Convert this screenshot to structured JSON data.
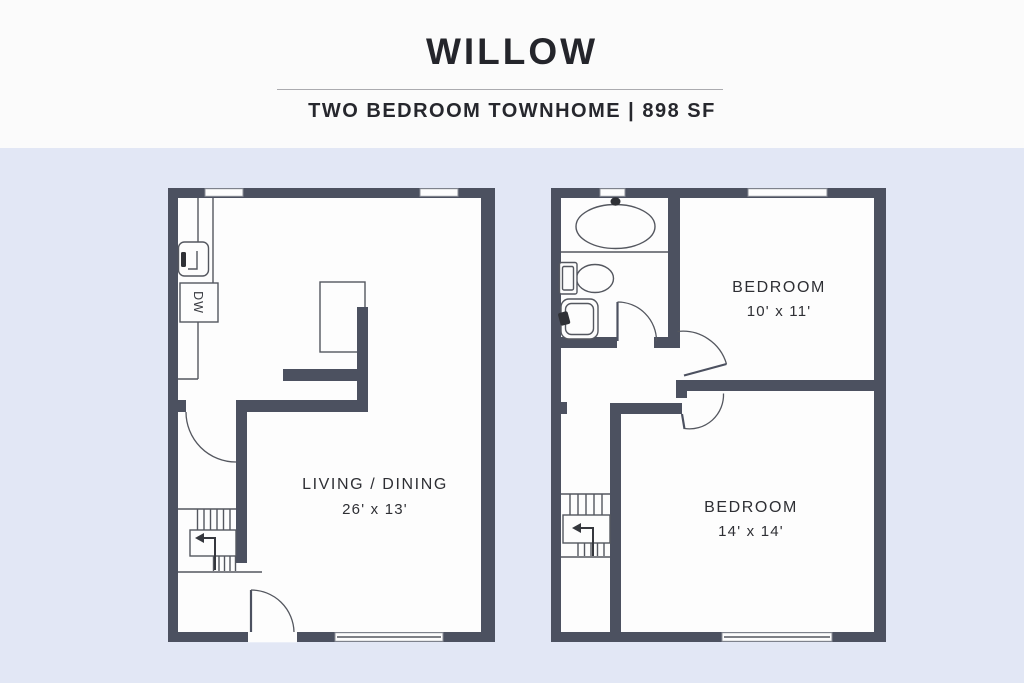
{
  "header": {
    "title": "WILLOW",
    "subtitle": "TWO BEDROOM TOWNHOME | 898 SF"
  },
  "floors": {
    "first": {
      "rooms": [
        {
          "label": "LIVING / DINING",
          "dimensions": "26' x 13'"
        }
      ],
      "dishwasher_label": "DW"
    },
    "second": {
      "rooms": [
        {
          "label": "BEDROOM",
          "dimensions": "10' x 11'"
        },
        {
          "label": "BEDROOM",
          "dimensions": "14' x 14'"
        }
      ]
    }
  },
  "colors": {
    "wall": "#4c5160",
    "background": "#e2e7f5",
    "header_background": "#fbfbfb",
    "line": "#54575f",
    "text": "#2e2f34",
    "divider": "#ababaf"
  }
}
